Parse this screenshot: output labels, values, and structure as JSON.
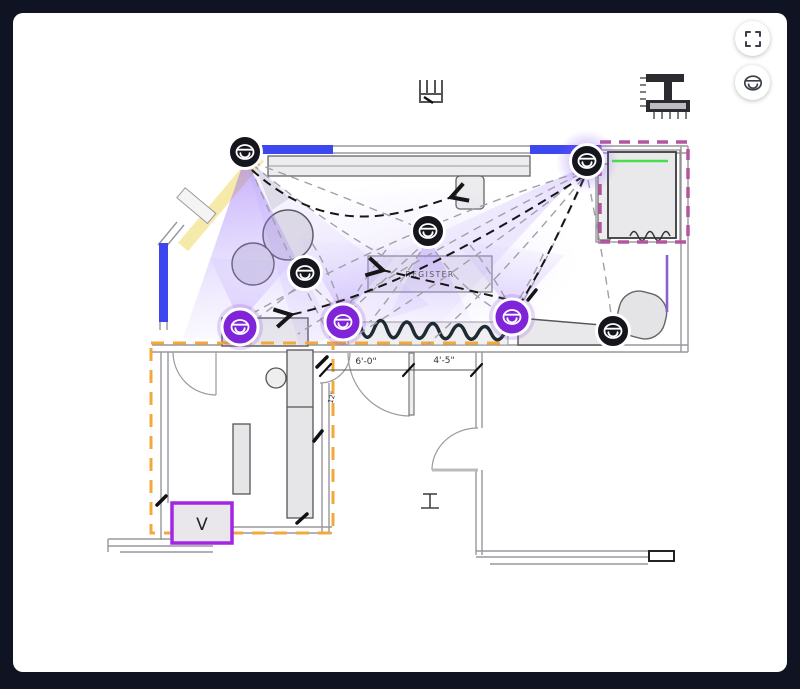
{
  "frame": {
    "background": "#0f1322",
    "surface": "#ffffff"
  },
  "controls": {
    "fullscreen_button": {
      "icon": "fullscreen-icon"
    },
    "camera_tool_button": {
      "icon": "dome-camera-icon"
    }
  },
  "floorplan": {
    "texts": {
      "register": "REGISTER",
      "vault": "V",
      "dim_a": "6'-0\"",
      "dim_b": "4'-5\"",
      "dim_c": "12\""
    },
    "colors": {
      "wall_highlight_blue": "#3d47f0",
      "window_highlight_yellow": "#f6e8a2",
      "coverage_purple": "#8b5cf6",
      "camera_dark": "#15151e",
      "camera_selected_purple": "#7f24d8",
      "selection_zone_orange": "#f3a83b",
      "fixture_zone_magenta": "#b2579f",
      "shelf_accent_green": "#47e04c",
      "vault_border_purple": "#a226e3",
      "wall_accent_purple": "#8a5fd0"
    },
    "cameras": [
      {
        "id": "1",
        "x": 245,
        "y": 152,
        "variant": "dark",
        "glow": false
      },
      {
        "id": "2",
        "x": 587,
        "y": 161,
        "variant": "dark",
        "glow": true
      },
      {
        "id": "3",
        "x": 428,
        "y": 231,
        "variant": "dark",
        "glow": false
      },
      {
        "id": "4",
        "x": 305,
        "y": 273,
        "variant": "dark",
        "glow": false
      },
      {
        "id": "5",
        "x": 240,
        "y": 327,
        "variant": "selected",
        "glow": false
      },
      {
        "id": "6",
        "x": 343,
        "y": 322,
        "variant": "selected",
        "glow": false
      },
      {
        "id": "7",
        "x": 512,
        "y": 317,
        "variant": "selected",
        "glow": false
      },
      {
        "id": "8",
        "x": 613,
        "y": 331,
        "variant": "dark",
        "glow": false
      }
    ]
  }
}
